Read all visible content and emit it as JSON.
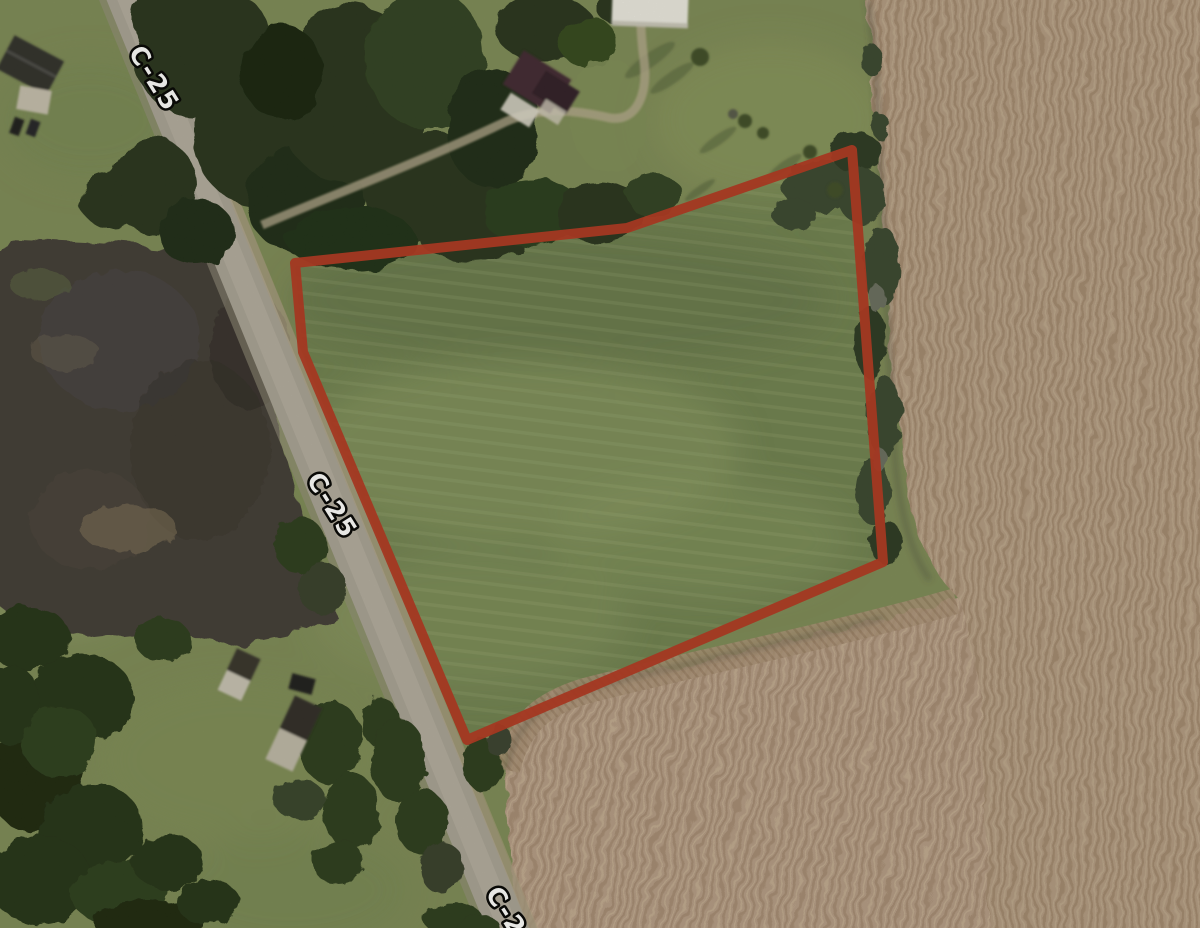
{
  "map": {
    "kind": "satellite-aerial-view",
    "road": {
      "name": "C-25",
      "labels": [
        "C-25",
        "C-25",
        "C-25"
      ]
    },
    "parcel": {
      "outline_color": "#b23620",
      "outline_width": 10,
      "vertices": [
        [
          852,
          150
        ],
        [
          627,
          228
        ],
        [
          295,
          263
        ],
        [
          303,
          352
        ],
        [
          467,
          740
        ],
        [
          883,
          562
        ]
      ]
    },
    "terrain": {
      "lawn_green": "#7d8a57",
      "parcel_green": "#6f8150",
      "field_tan": "#b29a82",
      "field_tan_dark": "#a3896f",
      "field_tan_light": "#bda78d",
      "forest_dark": "#26331c",
      "woods_dark": "#403a35",
      "road_gray": "#a8a296"
    }
  }
}
